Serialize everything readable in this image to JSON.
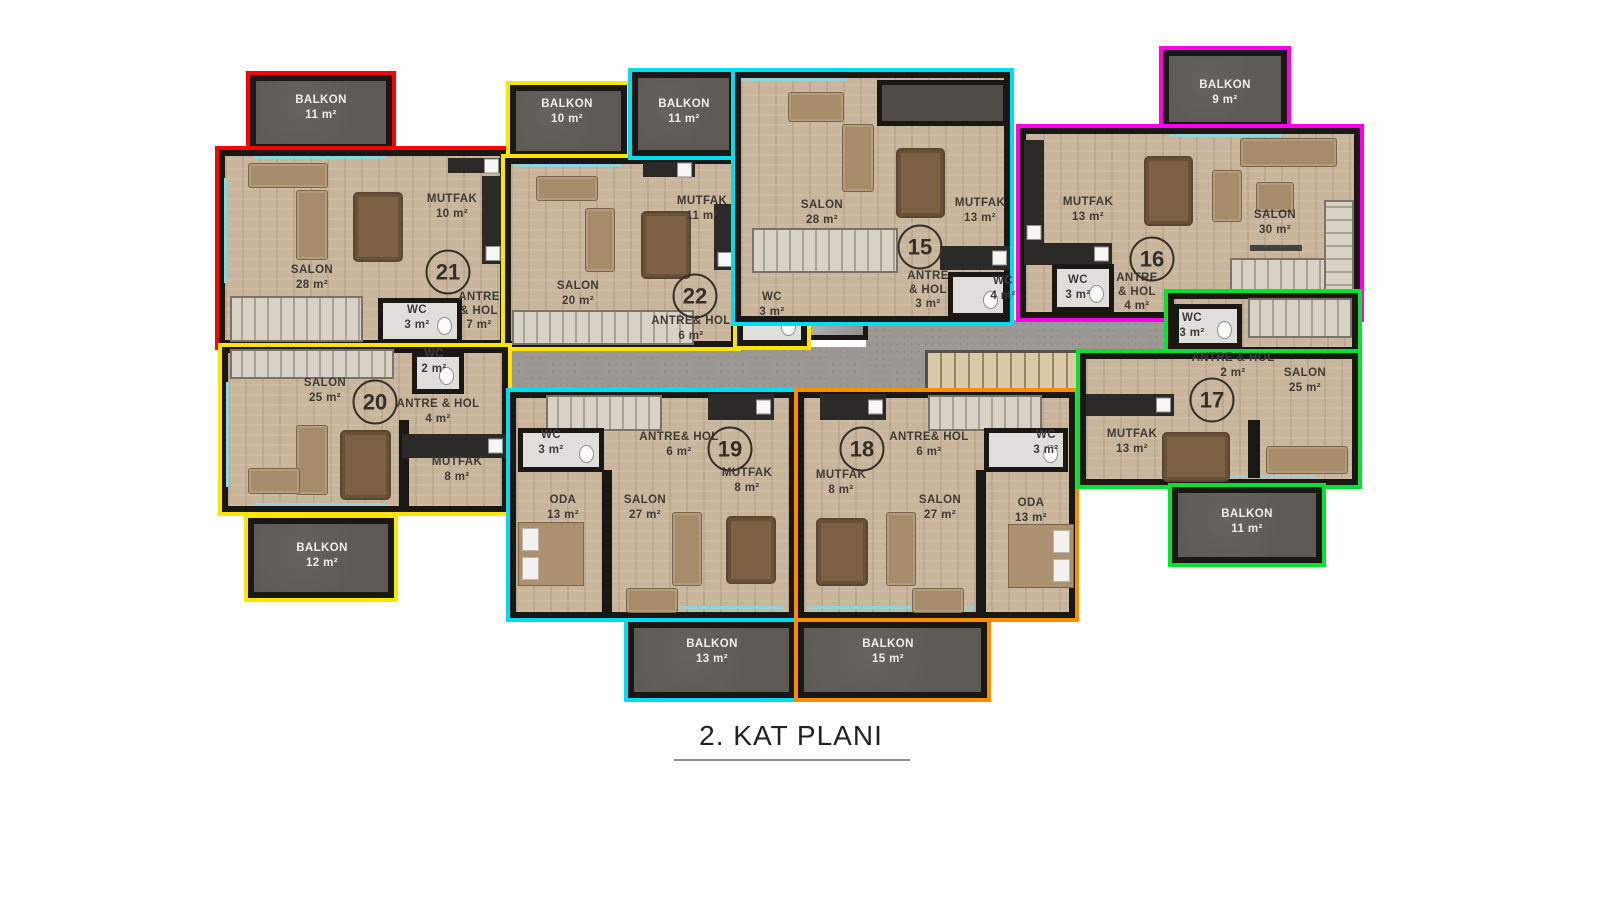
{
  "title": "2. KAT PLANI",
  "elevator": {
    "label": "ASANSÖR"
  },
  "apartments": [
    {
      "number": "21",
      "outline_color": "#ff0000",
      "rooms": [
        {
          "name": "BALKON",
          "area": "11 m²"
        },
        {
          "name": "SALON",
          "area": "28 m²"
        },
        {
          "name": "MUTFAK",
          "area": "10 m²"
        },
        {
          "name": "WC",
          "area": "3 m²"
        },
        {
          "name": "ANTRE & HOL",
          "area": "7 m²"
        }
      ]
    },
    {
      "number": "22",
      "outline_color": "#ffe400",
      "rooms": [
        {
          "name": "BALKON",
          "area": "10 m²"
        },
        {
          "name": "SALON",
          "area": "20 m²"
        },
        {
          "name": "MUTFAK",
          "area": "11 m²"
        },
        {
          "name": "ANTRE& HOL",
          "area": "6 m²"
        },
        {
          "name": "WC",
          "area": "3 m²"
        }
      ]
    },
    {
      "number": "15",
      "outline_color": "#00dcf2",
      "rooms": [
        {
          "name": "BALKON",
          "area": "11 m²"
        },
        {
          "name": "SALON",
          "area": "28 m²"
        },
        {
          "name": "MUTFAK",
          "area": "13 m²"
        },
        {
          "name": "ANTRE & HOL",
          "area": "3 m²"
        },
        {
          "name": "WC",
          "area": "4 m²"
        }
      ]
    },
    {
      "number": "16",
      "outline_color": "#ff00e8",
      "rooms": [
        {
          "name": "BALKON",
          "area": "9 m²"
        },
        {
          "name": "MUTFAK",
          "area": "13 m²"
        },
        {
          "name": "SALON",
          "area": "30 m²"
        },
        {
          "name": "WC",
          "area": "3 m²"
        },
        {
          "name": "ANTRE & HOL",
          "area": "4 m²"
        }
      ]
    },
    {
      "number": "20",
      "outline_color": "#ffe400",
      "rooms": [
        {
          "name": "SALON",
          "area": "25 m²"
        },
        {
          "name": "WC",
          "area": "2 m²"
        },
        {
          "name": "ANTRE & HOL",
          "area": "4 m²"
        },
        {
          "name": "MUTFAK",
          "area": "8 m²"
        },
        {
          "name": "BALKON",
          "area": "12 m²"
        }
      ]
    },
    {
      "number": "19",
      "outline_color": "#00dcf2",
      "rooms": [
        {
          "name": "WC",
          "area": "3 m²"
        },
        {
          "name": "ANTRE& HOL",
          "area": "6 m²"
        },
        {
          "name": "MUTFAK",
          "area": "8 m²"
        },
        {
          "name": "ODA",
          "area": "13 m²"
        },
        {
          "name": "SALON",
          "area": "27 m²"
        },
        {
          "name": "BALKON",
          "area": "13 m²"
        }
      ]
    },
    {
      "number": "18",
      "outline_color": "#ff8c00",
      "rooms": [
        {
          "name": "MUTFAK",
          "area": "8 m²"
        },
        {
          "name": "ANTRE& HOL",
          "area": "6 m²"
        },
        {
          "name": "WC",
          "area": "3 m²"
        },
        {
          "name": "SALON",
          "area": "27 m²"
        },
        {
          "name": "ODA",
          "area": "13 m²"
        },
        {
          "name": "BALKON",
          "area": "15 m²"
        }
      ]
    },
    {
      "number": "17",
      "outline_color": "#0ae032",
      "rooms": [
        {
          "name": "WC",
          "area": "3 m²"
        },
        {
          "name": "ANTRE & HOL",
          "area": "2 m²"
        },
        {
          "name": "SALON",
          "area": "25 m²"
        },
        {
          "name": "MUTFAK",
          "area": "13 m²"
        },
        {
          "name": "BALKON",
          "area": "11 m²"
        }
      ]
    }
  ]
}
